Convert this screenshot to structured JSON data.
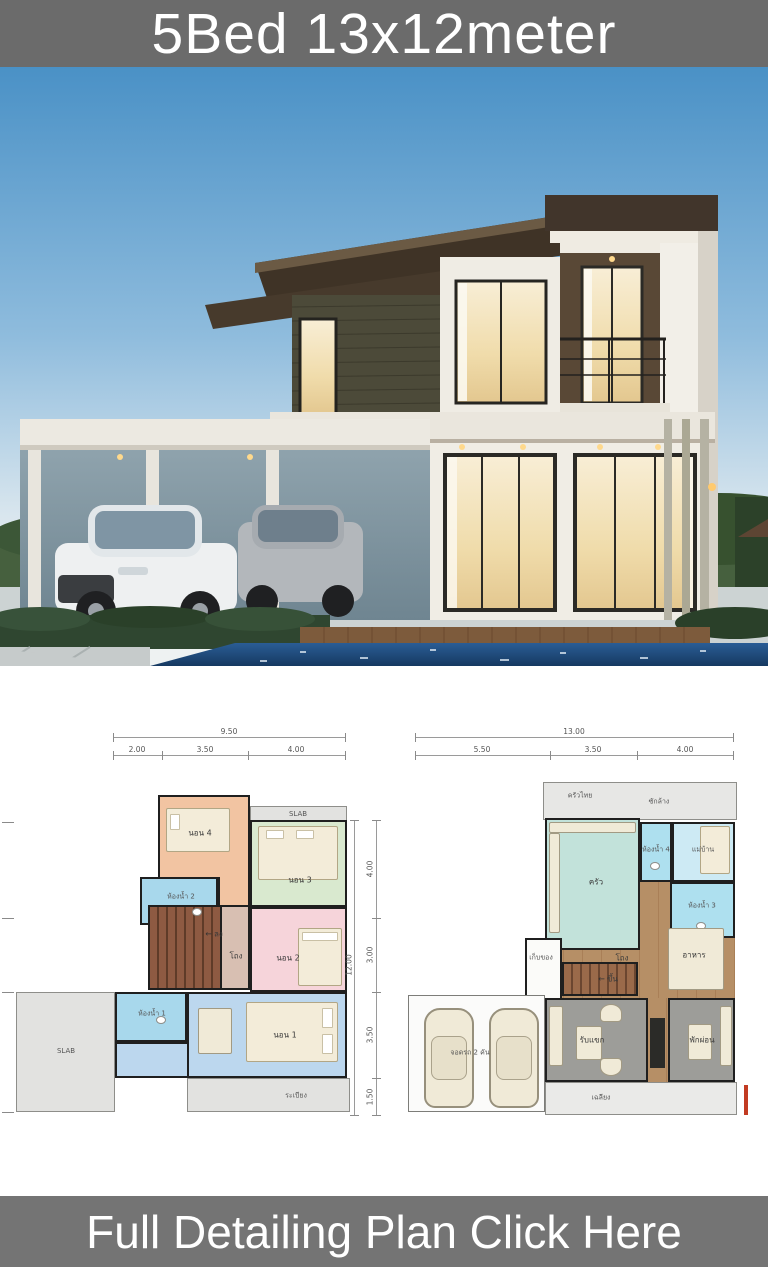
{
  "banner_top": {
    "title": "5Bed 13x12meter"
  },
  "banner_bottom": {
    "title": "Full Detailing Plan Click Here"
  },
  "icons": {
    "arrow_left": "←"
  },
  "colors": {
    "banner_gray": "#6b6b6b",
    "footer_gray": "#747474",
    "sky_blue": "#4a91c6",
    "pool_blue": "#1f4e85",
    "roof_brown": "#3f3326",
    "slat_olive": "#4c4a39",
    "warm_window": "#f5e6c2",
    "red_mark": "#c23b22"
  },
  "plans": {
    "second_floor": {
      "dim_total_top": "9.50",
      "dims_top": [
        "2.00",
        "3.50",
        "4.00"
      ],
      "dim_total_right": "12.00",
      "dims_right": [
        "4.00",
        "3.00",
        "3.50",
        "1.50"
      ],
      "rooms": {
        "bedroom4": "นอน 4",
        "bedroom3": "นอน 3",
        "bedroom2": "นอน 2",
        "bedroom1": "นอน 1",
        "bath2": "ห้องน้ำ 2",
        "bath1": "ห้องน้ำ 1",
        "hall": "โถง",
        "stairs_down": "ลง",
        "slab_top": "SLAB",
        "slab_left": "SLAB",
        "balcony": "ระเบียง"
      }
    },
    "first_floor": {
      "dim_total_top": "13.00",
      "dims_top": [
        "5.50",
        "3.50",
        "4.00"
      ],
      "rooms": {
        "thai_kitchen": "ครัวไทย",
        "laundry": "ซักล้าง",
        "kitchen": "ครัว",
        "bath4": "ห้องน้ำ 4",
        "maid": "แม่บ้าน",
        "bath3": "ห้องน้ำ 3",
        "storage": "เก็บของ",
        "hall": "โถง",
        "dining": "อาหาร",
        "stairs_up": "ขึ้น",
        "living": "รับแขก",
        "relax": "พักผ่อน",
        "carport": "จอดรถ 2 คัน",
        "porch": "เฉลียง"
      }
    }
  }
}
